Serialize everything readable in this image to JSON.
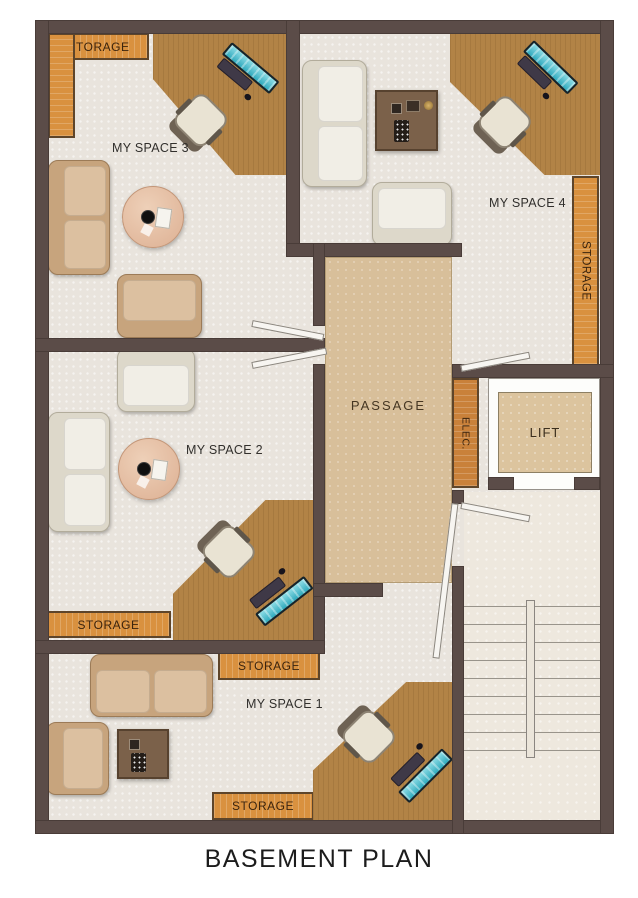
{
  "title": "BASEMENT PLAN",
  "rooms": {
    "space3": "MY SPACE 3",
    "space4": "MY SPACE 4",
    "space2": "MY SPACE 2",
    "space1": "MY SPACE 1",
    "passage": "PASSAGE",
    "lift": "LIFT",
    "elec": "ELEC."
  },
  "storages": {
    "space3_corner": "STORAGE",
    "space4_wall": "STORAGE",
    "space2_wall": "STORAGE",
    "space1_top": "STORAGE",
    "space1_bottom": "STORAGE"
  },
  "colors": {
    "wall": "#5b4c48",
    "floor": "#e9e4dd",
    "passage_floor": "#d8bf9a",
    "stair_floor": "#eee8de",
    "storage_wood": "#d9913f",
    "desk_wood": "#b28346",
    "lift_floor": "#dcc49e",
    "screen_teal": "#49c2d4"
  }
}
